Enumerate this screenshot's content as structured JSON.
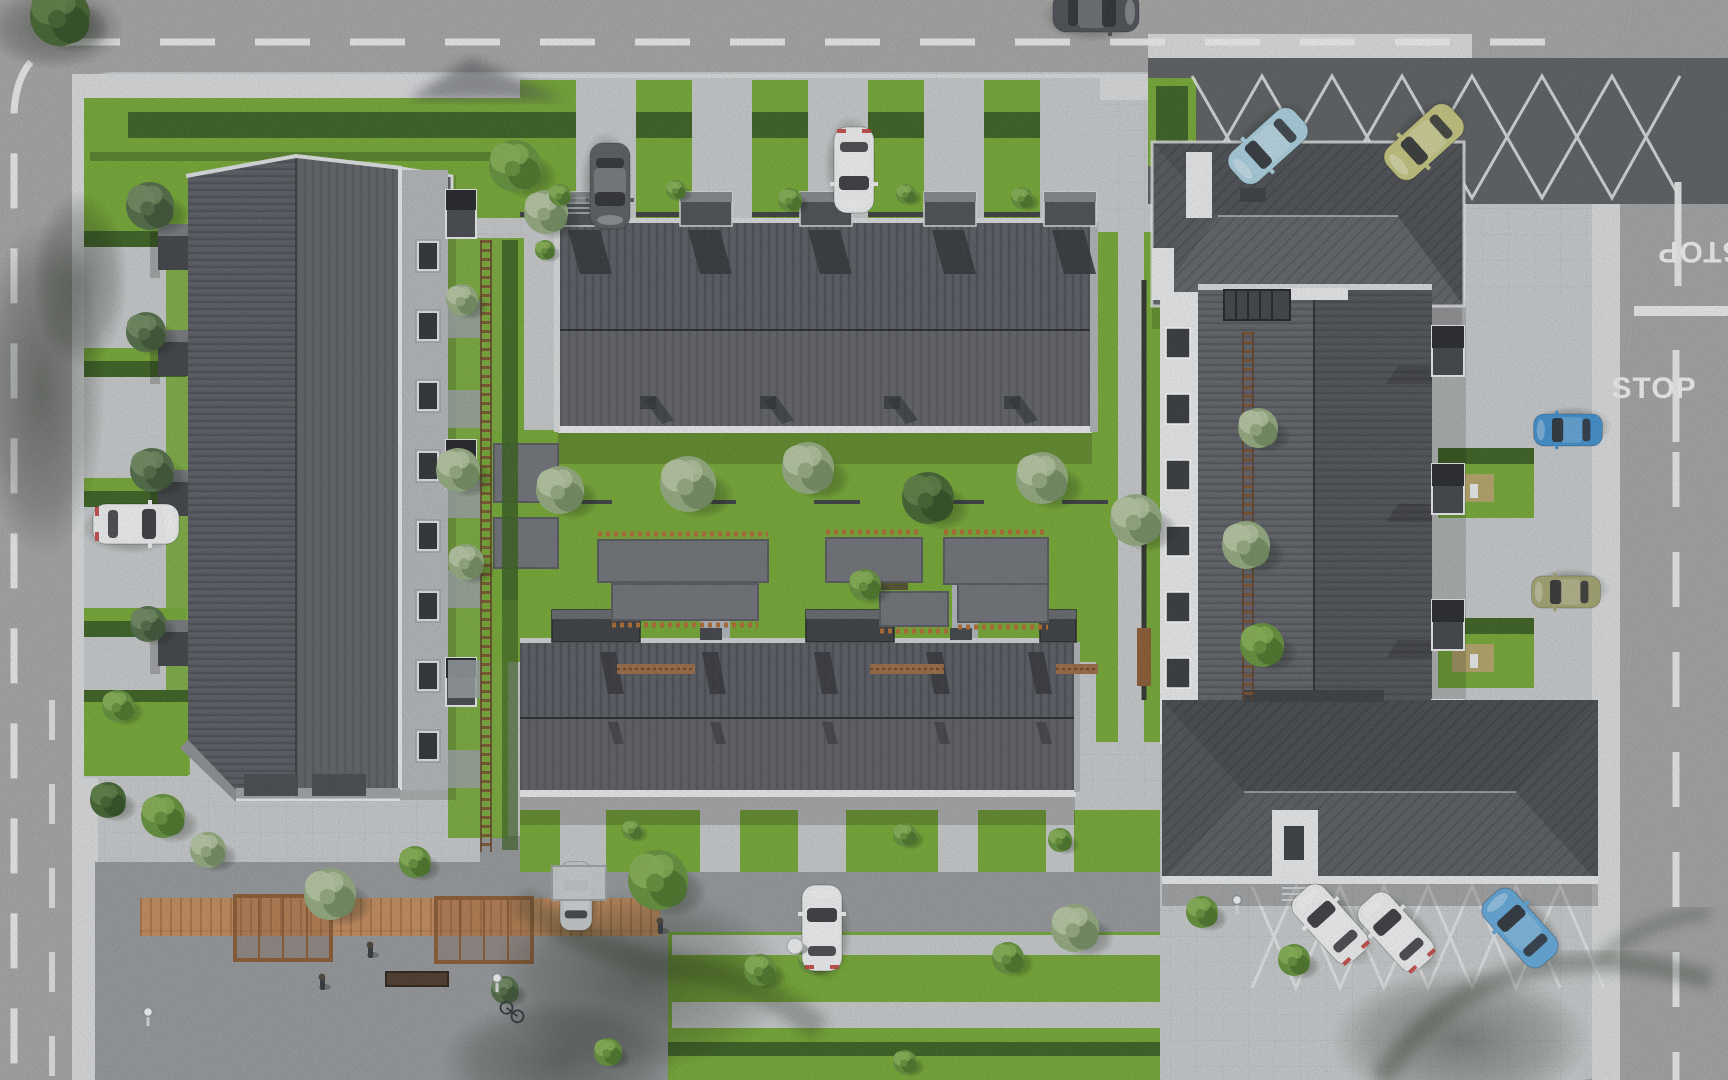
{
  "scene": {
    "description": "aerial top-down 3D render of a residential townhouse complex with central courtyard gardens, perimeter roads and parking"
  },
  "palette": {
    "asphalt": "#a5a5a6",
    "paving": "#c7cacc",
    "sidewalk": "#d9dbdd",
    "cobble": "#95989b",
    "cobbledark": "#5b5e61",
    "grass": "#74a833",
    "hedge": "#3a6020",
    "roofdark": "#46484d",
    "roofmid": "#565960",
    "rooflight": "#64676c",
    "white": "#eceeef",
    "wood": "#c28b5c",
    "rail": "#b06a30",
    "glass": "#2c2f33"
  },
  "road_markings": {
    "stop_label": "STOP",
    "line_color": "#eff1f2"
  },
  "cars": [
    {
      "name": "car-top-road",
      "x": 1096,
      "y": 12,
      "rot": 90,
      "color": "#4b4f54",
      "scale": 1,
      "tail": false
    },
    {
      "name": "car-parking-ne-blue",
      "x": 1268,
      "y": 146,
      "rot": 228,
      "color": "#a9cfdf",
      "scale": 1,
      "tail": false
    },
    {
      "name": "car-parking-ne-green",
      "x": 1424,
      "y": 142,
      "rot": 228,
      "color": "#c3c47e",
      "scale": 1,
      "tail": false
    },
    {
      "name": "car-driveway-top-white",
      "x": 854,
      "y": 170,
      "rot": 180,
      "color": "#eef0f1",
      "scale": 1,
      "tail": true
    },
    {
      "name": "car-driveway-top-gray",
      "x": 610,
      "y": 186,
      "rot": 180,
      "color": "#585c61",
      "scale": 1,
      "tail": false
    },
    {
      "name": "car-driveway-left-white",
      "x": 136,
      "y": 524,
      "rot": 90,
      "color": "#eef0f1",
      "scale": 1,
      "tail": true
    },
    {
      "name": "car-driveway-bottom-white",
      "x": 822,
      "y": 928,
      "rot": 0,
      "color": "#eef0f1",
      "scale": 1,
      "tail": true
    },
    {
      "name": "car-carport-silver",
      "x": 576,
      "y": 896,
      "rot": 0,
      "color": "#c5c8ca",
      "scale": 0.8,
      "tail": false
    },
    {
      "name": "car-parking-se-white-1",
      "x": 1330,
      "y": 924,
      "rot": 318,
      "color": "#eef0f1",
      "scale": 1,
      "tail": true
    },
    {
      "name": "car-parking-se-white-2",
      "x": 1396,
      "y": 932,
      "rot": 318,
      "color": "#eef0f1",
      "scale": 1,
      "tail": true
    },
    {
      "name": "car-parking-se-blue",
      "x": 1520,
      "y": 928,
      "rot": 318,
      "color": "#62a8da",
      "scale": 1,
      "tail": false
    },
    {
      "name": "car-driveway-right-blue",
      "x": 1568,
      "y": 430,
      "rot": 270,
      "color": "#3f8fcd",
      "scale": 0.8,
      "tail": false
    },
    {
      "name": "car-driveway-right-khaki",
      "x": 1566,
      "y": 592,
      "rot": 270,
      "color": "#a3a470",
      "scale": 0.8,
      "tail": false
    }
  ],
  "trees": [
    {
      "x": 60,
      "y": 16,
      "r": 30,
      "tone": "dark"
    },
    {
      "x": 150,
      "y": 206,
      "r": 24,
      "tone": "conifer"
    },
    {
      "x": 146,
      "y": 332,
      "r": 20,
      "tone": "conifer"
    },
    {
      "x": 152,
      "y": 470,
      "r": 22,
      "tone": "conifer"
    },
    {
      "x": 148,
      "y": 624,
      "r": 18,
      "tone": "conifer"
    },
    {
      "x": 118,
      "y": 706,
      "r": 16,
      "tone": "green"
    },
    {
      "x": 515,
      "y": 166,
      "r": 26,
      "tone": "green"
    },
    {
      "x": 546,
      "y": 212,
      "r": 22,
      "tone": "sage"
    },
    {
      "x": 462,
      "y": 300,
      "r": 16,
      "tone": "sage"
    },
    {
      "x": 458,
      "y": 470,
      "r": 22,
      "tone": "sage"
    },
    {
      "x": 466,
      "y": 562,
      "r": 18,
      "tone": "sage"
    },
    {
      "x": 108,
      "y": 800,
      "r": 18,
      "tone": "dark"
    },
    {
      "x": 163,
      "y": 816,
      "r": 22,
      "tone": "green"
    },
    {
      "x": 208,
      "y": 850,
      "r": 18,
      "tone": "sage"
    },
    {
      "x": 330,
      "y": 894,
      "r": 26,
      "tone": "sage"
    },
    {
      "x": 415,
      "y": 862,
      "r": 16,
      "tone": "green"
    },
    {
      "x": 658,
      "y": 880,
      "r": 30,
      "tone": "green"
    },
    {
      "x": 560,
      "y": 490,
      "r": 24,
      "tone": "sage"
    },
    {
      "x": 688,
      "y": 484,
      "r": 28,
      "tone": "sage"
    },
    {
      "x": 808,
      "y": 468,
      "r": 26,
      "tone": "sage"
    },
    {
      "x": 928,
      "y": 498,
      "r": 26,
      "tone": "dark"
    },
    {
      "x": 1042,
      "y": 478,
      "r": 26,
      "tone": "sage"
    },
    {
      "x": 1136,
      "y": 520,
      "r": 26,
      "tone": "sage"
    },
    {
      "x": 1246,
      "y": 545,
      "r": 24,
      "tone": "sage"
    },
    {
      "x": 1258,
      "y": 428,
      "r": 20,
      "tone": "sage"
    },
    {
      "x": 1262,
      "y": 645,
      "r": 22,
      "tone": "green"
    },
    {
      "x": 865,
      "y": 585,
      "r": 16,
      "tone": "green"
    },
    {
      "x": 560,
      "y": 195,
      "r": 11,
      "tone": "green"
    },
    {
      "x": 676,
      "y": 190,
      "r": 10,
      "tone": "green"
    },
    {
      "x": 790,
      "y": 200,
      "r": 12,
      "tone": "green"
    },
    {
      "x": 906,
      "y": 194,
      "r": 10,
      "tone": "green"
    },
    {
      "x": 1022,
      "y": 198,
      "r": 11,
      "tone": "green"
    },
    {
      "x": 905,
      "y": 835,
      "r": 12,
      "tone": "green"
    },
    {
      "x": 1060,
      "y": 840,
      "r": 12,
      "tone": "green"
    },
    {
      "x": 632,
      "y": 830,
      "r": 10,
      "tone": "green"
    },
    {
      "x": 760,
      "y": 970,
      "r": 16,
      "tone": "green"
    },
    {
      "x": 812,
      "y": 960,
      "r": 14,
      "tone": "green"
    },
    {
      "x": 1008,
      "y": 958,
      "r": 16,
      "tone": "green"
    },
    {
      "x": 1075,
      "y": 928,
      "r": 24,
      "tone": "sage"
    },
    {
      "x": 1294,
      "y": 960,
      "r": 16,
      "tone": "green"
    },
    {
      "x": 1202,
      "y": 912,
      "r": 16,
      "tone": "green"
    },
    {
      "x": 505,
      "y": 990,
      "r": 14,
      "tone": "conifer"
    },
    {
      "x": 608,
      "y": 1052,
      "r": 14,
      "tone": "green"
    },
    {
      "x": 905,
      "y": 1062,
      "r": 12,
      "tone": "green"
    },
    {
      "x": 545,
      "y": 250,
      "r": 10,
      "tone": "green"
    }
  ],
  "people": [
    {
      "x": 370,
      "y": 952
    },
    {
      "x": 322,
      "y": 984
    },
    {
      "x": 660,
      "y": 928
    }
  ],
  "lamps": [
    {
      "x": 148,
      "y": 1012
    },
    {
      "x": 497,
      "y": 978
    },
    {
      "x": 1237,
      "y": 900
    }
  ],
  "bike": {
    "x": 512,
    "y": 1012
  },
  "round_table": {
    "x": 795,
    "y": 946
  }
}
